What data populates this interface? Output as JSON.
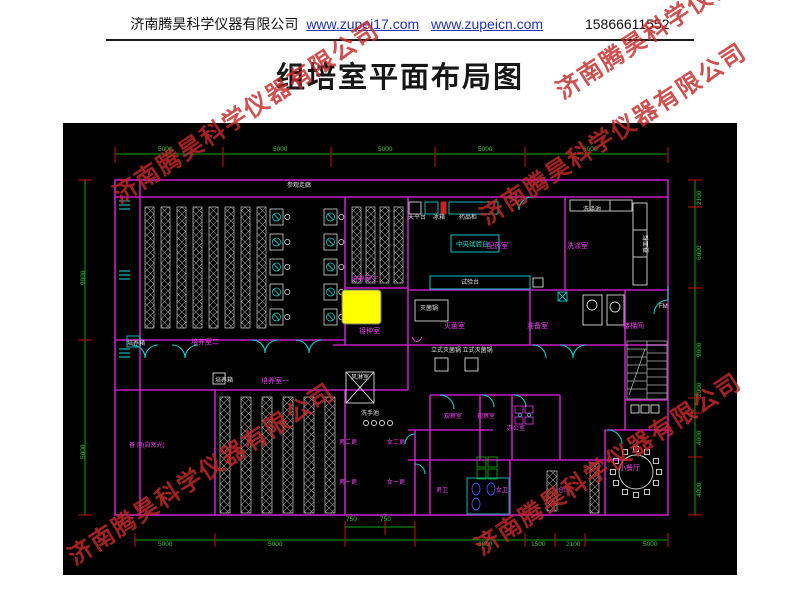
{
  "header": {
    "company": "济南腾昊科学仪器有限公司",
    "link1": "www.zupei17.com",
    "link2": "www.zupeicn.com",
    "phone": "15866611552"
  },
  "title": "组培室平面布局图",
  "watermark": {
    "text": "济南腾昊科学仪器有限公司",
    "color": "#c62828"
  },
  "colors": {
    "wall": "#c31ec3",
    "dimension": "#00a800",
    "tick": "#cc1111",
    "door": "#00cdcd",
    "equipment": "#d8d8d8",
    "room_label": "#ee3fee",
    "highlight": "#ffff00",
    "background": "#000000"
  },
  "drawing": {
    "annotations": [
      {
        "t": "参观走廊",
        "cls": "equip",
        "x": 224,
        "y": 60
      },
      {
        "t": "培养室二",
        "cls": "room",
        "x": 128,
        "y": 216
      },
      {
        "t": "培养室三",
        "cls": "room",
        "x": 288,
        "y": 153
      },
      {
        "t": "培养室一",
        "cls": "room",
        "x": 198,
        "y": 255
      },
      {
        "t": "接种室",
        "cls": "room",
        "x": 296,
        "y": 205
      },
      {
        "t": "配药室",
        "cls": "room",
        "x": 424,
        "y": 120
      },
      {
        "t": "洗涤室",
        "cls": "room",
        "x": 504,
        "y": 120
      },
      {
        "t": "灭菌室",
        "cls": "room",
        "x": 381,
        "y": 200
      },
      {
        "t": "准备室",
        "cls": "room",
        "x": 464,
        "y": 200
      },
      {
        "t": "楼梯间",
        "cls": "room",
        "x": 560,
        "y": 200
      },
      {
        "t": "小餐厅",
        "cls": "room",
        "x": 556,
        "y": 342
      },
      {
        "t": "备 用(自然光)",
        "cls": "rooms",
        "x": 66,
        "y": 320
      },
      {
        "t": "男二更",
        "cls": "rooms",
        "x": 276,
        "y": 317
      },
      {
        "t": "女二更",
        "cls": "rooms",
        "x": 324,
        "y": 317
      },
      {
        "t": "男一更",
        "cls": "rooms",
        "x": 276,
        "y": 357
      },
      {
        "t": "女一更",
        "cls": "rooms",
        "x": 324,
        "y": 357
      },
      {
        "t": "观察室",
        "cls": "rooms",
        "x": 381,
        "y": 291
      },
      {
        "t": "观察室",
        "cls": "rooms",
        "x": 414,
        "y": 291
      },
      {
        "t": "办公室",
        "cls": "rooms",
        "x": 444,
        "y": 303
      },
      {
        "t": "男卫",
        "cls": "rooms",
        "x": 373,
        "y": 365
      },
      {
        "t": "女卫",
        "cls": "rooms",
        "x": 433,
        "y": 365
      },
      {
        "t": "仓库",
        "cls": "rooms",
        "x": 495,
        "y": 365
      },
      {
        "t": "天平台",
        "cls": "equip",
        "x": 345,
        "y": 92
      },
      {
        "t": "冰箱",
        "cls": "equip",
        "x": 370,
        "y": 92
      },
      {
        "t": "药品柜",
        "cls": "equip",
        "x": 396,
        "y": 92
      },
      {
        "t": "中央试验台",
        "cls": "equipc",
        "x": 393,
        "y": 119
      },
      {
        "t": "试验台",
        "cls": "equip",
        "x": 398,
        "y": 157
      },
      {
        "t": "灭菌锅",
        "cls": "equip",
        "x": 357,
        "y": 183
      },
      {
        "t": "立式灭菌锅 立式灭菌锅",
        "cls": "equip",
        "x": 368,
        "y": 225
      },
      {
        "t": "培养箱",
        "cls": "equip",
        "x": 64,
        "y": 218
      },
      {
        "t": "培养箱",
        "cls": "equip",
        "x": 152,
        "y": 255
      },
      {
        "t": "风淋室",
        "cls": "equip",
        "x": 288,
        "y": 252
      },
      {
        "t": "洗手池",
        "cls": "equip",
        "x": 298,
        "y": 288
      },
      {
        "t": "洗涤池",
        "cls": "equip",
        "x": 520,
        "y": 84
      },
      {
        "t": "器皿柜",
        "cls": "dimv2",
        "x": 581,
        "y": 130
      },
      {
        "t": "FM",
        "cls": "equip",
        "x": 596,
        "y": 181
      },
      {
        "t": "5000",
        "cls": "dim",
        "x": 95,
        "y": 24
      },
      {
        "t": "5000",
        "cls": "dim",
        "x": 210,
        "y": 24
      },
      {
        "t": "5000",
        "cls": "dim",
        "x": 315,
        "y": 24
      },
      {
        "t": "5000",
        "cls": "dim",
        "x": 415,
        "y": 24
      },
      {
        "t": "6000",
        "cls": "dim",
        "x": 520,
        "y": 24
      },
      {
        "t": "5000",
        "cls": "dim",
        "x": 95,
        "y": 419
      },
      {
        "t": "5000",
        "cls": "dim",
        "x": 205,
        "y": 419
      },
      {
        "t": "750",
        "cls": "dim",
        "x": 283,
        "y": 394
      },
      {
        "t": "750",
        "cls": "dim",
        "x": 317,
        "y": 394
      },
      {
        "t": "6000",
        "cls": "dim",
        "x": 415,
        "y": 419
      },
      {
        "t": "1500",
        "cls": "dim",
        "x": 468,
        "y": 419
      },
      {
        "t": "2100",
        "cls": "dim",
        "x": 503,
        "y": 419
      },
      {
        "t": "5000",
        "cls": "dim",
        "x": 580,
        "y": 419
      },
      {
        "t": "9000",
        "cls": "dimv",
        "x": 18,
        "y": 162
      },
      {
        "t": "5000",
        "cls": "dimv",
        "x": 18,
        "y": 336
      },
      {
        "t": "2100",
        "cls": "dimv",
        "x": 634,
        "y": 82
      },
      {
        "t": "6000",
        "cls": "dimv",
        "x": 634,
        "y": 137
      },
      {
        "t": "9000",
        "cls": "dimv",
        "x": 634,
        "y": 234
      },
      {
        "t": "2000",
        "cls": "dimv",
        "x": 634,
        "y": 274
      },
      {
        "t": "4000",
        "cls": "dimv",
        "x": 634,
        "y": 322
      },
      {
        "t": "4000",
        "cls": "dimv",
        "x": 634,
        "y": 374
      }
    ]
  }
}
